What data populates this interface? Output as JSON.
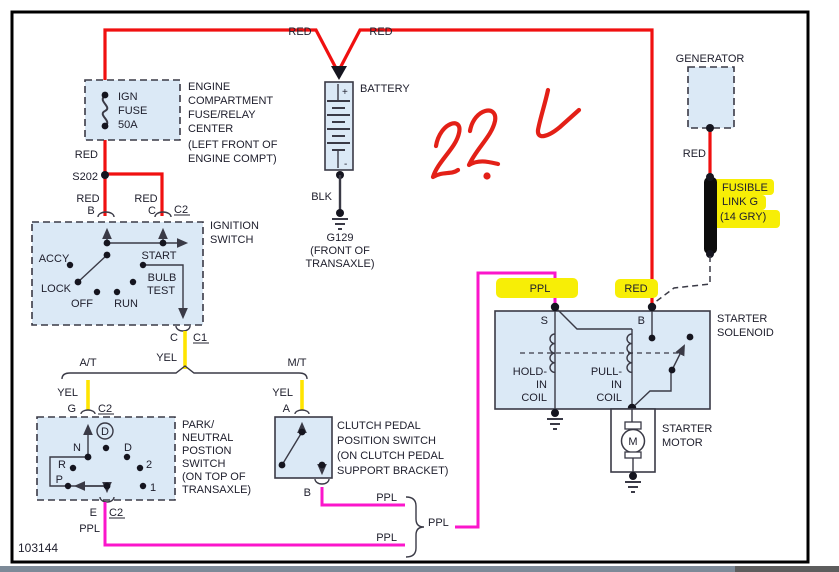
{
  "doc_number": "103144",
  "handwritten_note": "2.2L",
  "colors": {
    "wire_red": "#f01010",
    "wire_yellow": "#ffe400",
    "wire_purple": "#fb16cb",
    "highlight_yellow": "#f7ee06",
    "component_fill": "#dbe9f6",
    "line": "#3a3a46"
  },
  "wires": {
    "red": "RED",
    "yellow": "YEL",
    "purple": "PPL",
    "black": "BLK"
  },
  "terminals": {
    "a": "A",
    "b": "B",
    "c": "C",
    "e": "E",
    "g": "G",
    "s": "S"
  },
  "connectors": {
    "c1": "C1",
    "c2": "C2",
    "splice": "S202"
  },
  "branches": {
    "at": "A/T",
    "mt": "M/T"
  },
  "fuse": {
    "l1": "IGN",
    "l2": "FUSE",
    "l3": "50A"
  },
  "fuse_center": {
    "l1": "ENGINE",
    "l2": "COMPARTMENT",
    "l3": "FUSE/RELAY",
    "l4": "CENTER",
    "l5": "(LEFT FRONT OF",
    "l6": "ENGINE COMPT)"
  },
  "battery": {
    "label": "BATTERY",
    "plus": "+",
    "minus": "-"
  },
  "battery_ground": {
    "id": "G129",
    "l1": "(FRONT OF",
    "l2": "TRANSAXLE)"
  },
  "generator": {
    "label": "GENERATOR"
  },
  "fusible_link": {
    "l1": "FUSIBLE",
    "l2": "LINK G",
    "l3": "(14 GRY)"
  },
  "ignition_switch": {
    "l1": "IGNITION",
    "l2": "SWITCH",
    "accy": "ACCY",
    "lock": "LOCK",
    "off": "OFF",
    "run": "RUN",
    "start": "START",
    "bulb": "BULB",
    "test": "TEST"
  },
  "pnp_switch": {
    "l1": "PARK/",
    "l2": "NEUTRAL",
    "l3": "POSTION",
    "l4": "SWITCH",
    "l5": "(ON TOP OF",
    "l6": "TRANSAXLE)",
    "n": "N",
    "d": "D",
    "r": "R",
    "p": "P",
    "pos2": "2",
    "pos1": "1"
  },
  "clutch_switch": {
    "l1": "CLUTCH PEDAL",
    "l2": "POSITION SWITCH",
    "l3": "(ON CLUTCH PEDAL",
    "l4": "SUPPORT BRACKET)"
  },
  "solenoid": {
    "l1": "STARTER",
    "l2": "SOLENOID",
    "hold1": "HOLD-",
    "hold2": "IN",
    "hold3": "COIL",
    "pull1": "PULL-",
    "pull2": "IN",
    "pull3": "COIL"
  },
  "motor": {
    "m": "M",
    "l1": "STARTER",
    "l2": "MOTOR"
  }
}
